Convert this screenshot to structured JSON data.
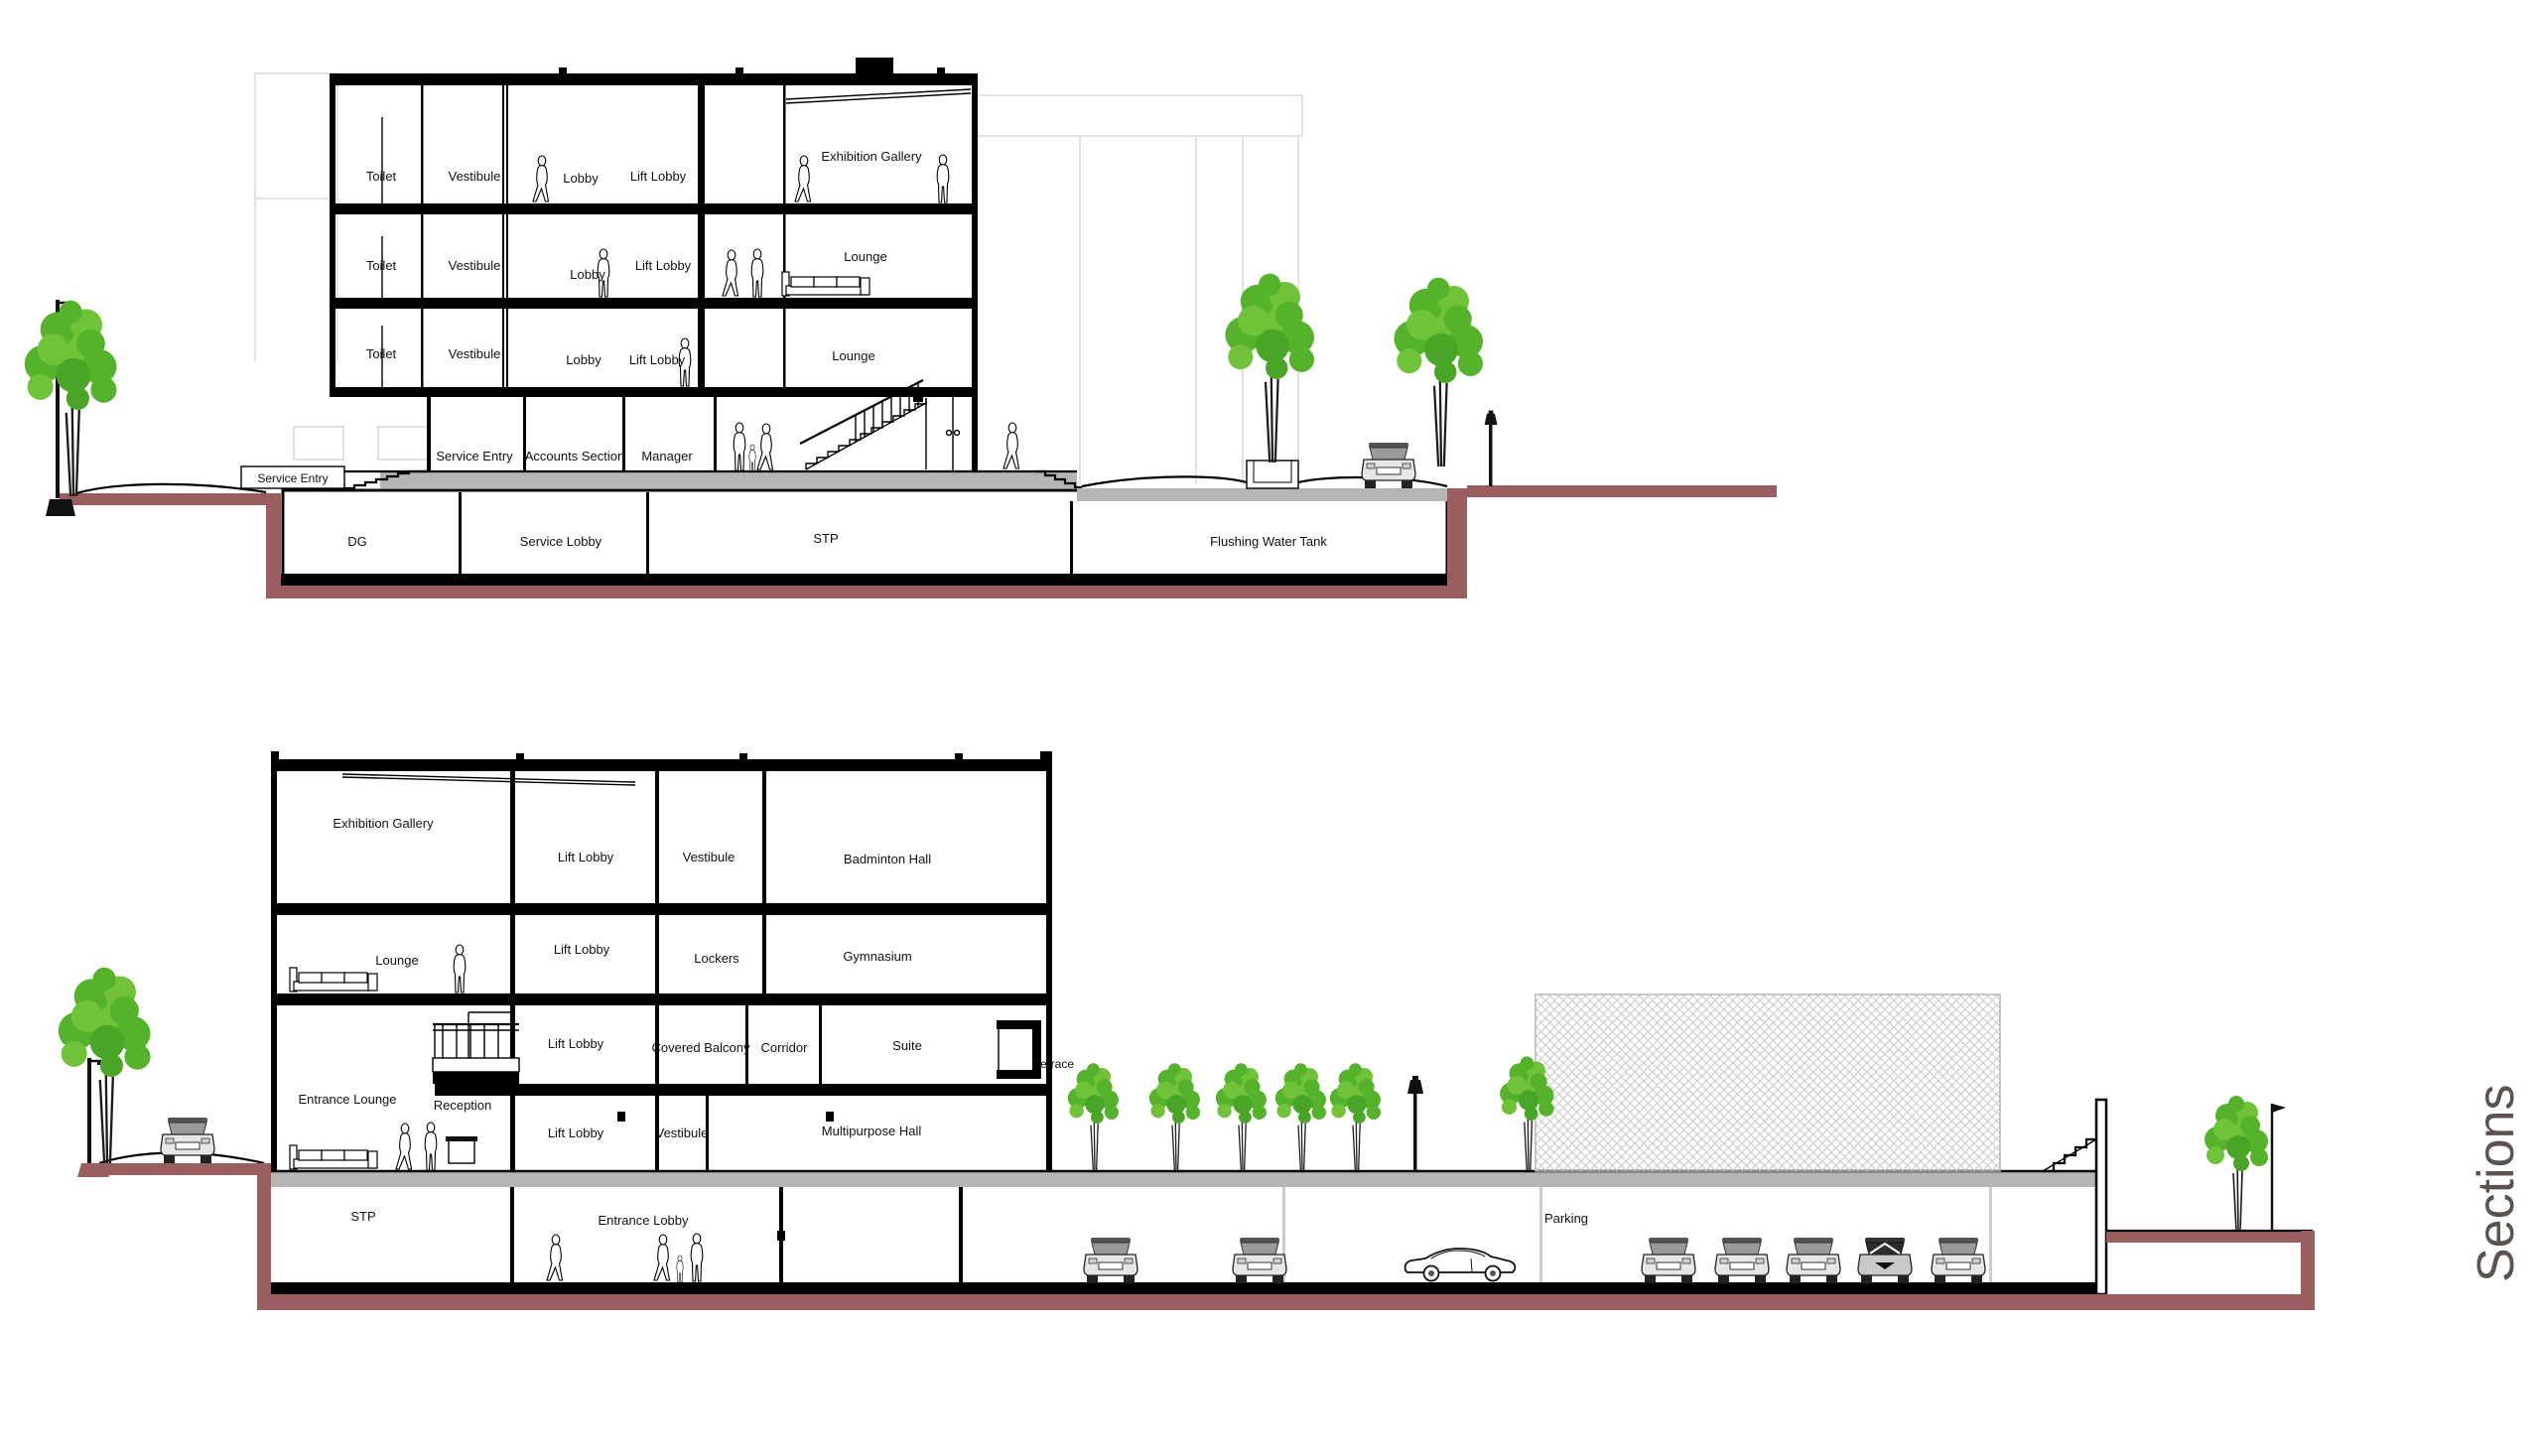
{
  "title": {
    "text": "Sections"
  },
  "palette": {
    "earth": "#9a5e5e",
    "slab_gray": "#b5b5b5",
    "tree_green": "#55b22b",
    "tree_green_light": "#70c238",
    "line": "#000000",
    "faint_background": "#d9d9d9",
    "title_color": "#5c5350"
  },
  "section_a": {
    "f1": {
      "toilet": "Toilet",
      "vestibule": "Vestibule",
      "lobby": "Lobby",
      "lift_lobby": "Lift Lobby",
      "gallery": "Exhibition Gallery"
    },
    "f2": {
      "toilet": "Toilet",
      "vestibule": "Vestibule",
      "lobby": "Lobby",
      "lift_lobby": "Lift Lobby",
      "lounge": "Lounge"
    },
    "f3": {
      "toilet": "Toilet",
      "vestibule": "Vestibule",
      "lobby": "Lobby",
      "lift_lobby": "Lift Lobby",
      "lounge": "Lounge"
    },
    "ground": {
      "ramp": "Service Entry",
      "service_entry": "Service Entry",
      "accounts": "Accounts Section",
      "manager": "Manager"
    },
    "basement": {
      "dg": "DG",
      "service_lobby": "Service Lobby",
      "stp": "STP",
      "flushing": "Flushing Water Tank"
    }
  },
  "section_b": {
    "f1": {
      "gallery": "Exhibition Gallery",
      "lift_lobby": "Lift Lobby",
      "vestibule": "Vestibule",
      "badminton": "Badminton Hall"
    },
    "f2": {
      "lounge": "Lounge",
      "lift_lobby": "Lift Lobby",
      "lockers": "Lockers",
      "gym": "Gymnasium"
    },
    "f3": {
      "lift_lobby": "Lift Lobby",
      "covered_balcony": "Covered Balcony",
      "corridor": "Corridor",
      "suite": "Suite",
      "terrace": "Terrace"
    },
    "f4": {
      "entrance_lounge": "Entrance Lounge",
      "reception": "Reception",
      "lift_lobby": "Lift Lobby",
      "vestibule": "Vestibule",
      "hall": "Multipurpose Hall"
    },
    "basement": {
      "stp": "STP",
      "entrance_lobby": "Entrance Lobby",
      "parking": "Parking"
    }
  }
}
